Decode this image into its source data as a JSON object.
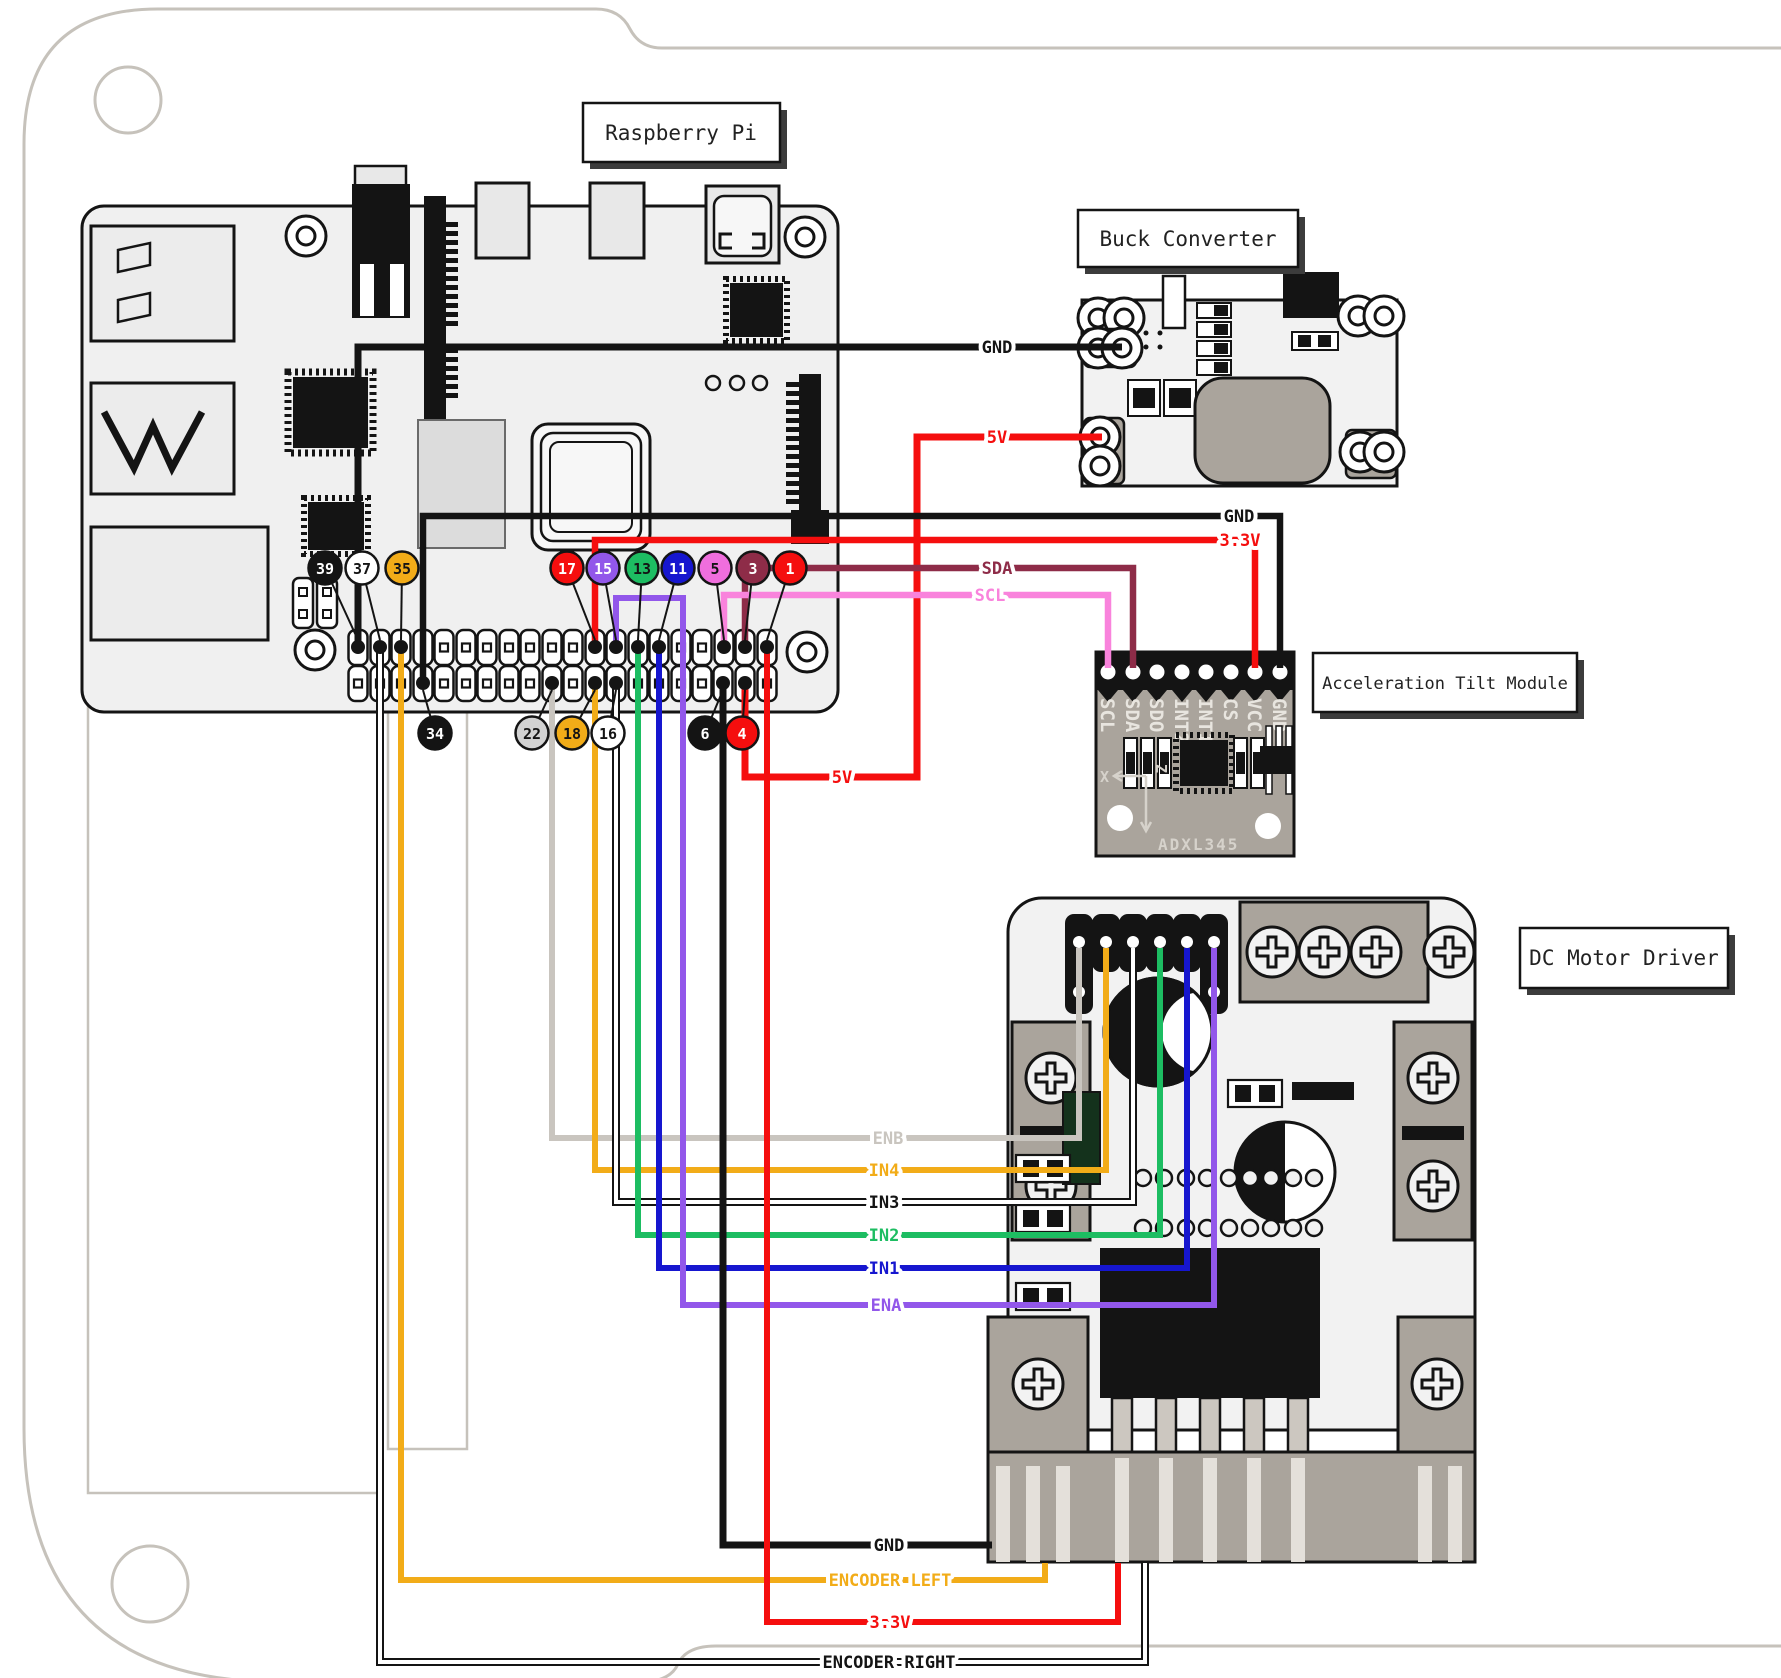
{
  "title_boxes": {
    "pi": "Raspberry Pi",
    "buck": "Buck Converter",
    "tilt": "Acceleration Tilt Module",
    "driver": "DC Motor Driver"
  },
  "pi_pins": {
    "p39": {
      "n": "39",
      "color": "#141414"
    },
    "p37": {
      "n": "37",
      "color": "#ffffff"
    },
    "p35": {
      "n": "35",
      "color": "#f2ac18"
    },
    "p17": {
      "n": "17",
      "color": "#f50e0e"
    },
    "p15": {
      "n": "15",
      "color": "#9257ea"
    },
    "p13": {
      "n": "13",
      "color": "#1dbd62"
    },
    "p11": {
      "n": "11",
      "color": "#1616cf"
    },
    "p5": {
      "n": "5",
      "color": "#f06edd"
    },
    "p3": {
      "n": "3",
      "color": "#8e2c48"
    },
    "p1": {
      "n": "1",
      "color": "#f50e0e"
    },
    "p34": {
      "n": "34",
      "color": "#141414"
    },
    "p22": {
      "n": "22",
      "color": "#d2d2d2"
    },
    "p18": {
      "n": "18",
      "color": "#f2ac18"
    },
    "p16": {
      "n": "16",
      "color": "#ffffff"
    },
    "p6": {
      "n": "6",
      "color": "#141414"
    },
    "p4": {
      "n": "4",
      "color": "#f50e0e"
    }
  },
  "wires": {
    "gnd_buck": {
      "label": "GND",
      "color": "#141414"
    },
    "v5": {
      "label": "5V",
      "color": "#f50e0e"
    },
    "gnd_tilt": {
      "label": "GND",
      "color": "#141414"
    },
    "v33_tilt": {
      "label": "3.3V",
      "color": "#f50e0e"
    },
    "sda": {
      "label": "SDA",
      "color": "#8e2c48"
    },
    "scl": {
      "label": "SCL",
      "color": "#f983dc"
    },
    "enb": {
      "label": "ENB",
      "color": "#c9c5bf"
    },
    "in4": {
      "label": "IN4",
      "color": "#f2ac18"
    },
    "in3": {
      "label": "IN3",
      "color": "#141414"
    },
    "in2": {
      "label": "IN2",
      "color": "#1dbd62"
    },
    "in1": {
      "label": "IN1",
      "color": "#1616cf"
    },
    "ena": {
      "label": "ENA",
      "color": "#9257ea"
    },
    "gnd_driver": {
      "label": "GND",
      "color": "#141414"
    },
    "enc_left": {
      "label": "ENCODER LEFT",
      "color": "#f2ac18"
    },
    "v33_driver": {
      "label": "3.3V",
      "color": "#f50e0e"
    },
    "enc_right": {
      "label": "ENCODER RIGHT",
      "color": "#141414"
    }
  },
  "tilt": {
    "pins": [
      "SCL",
      "SDA",
      "SDO",
      "INT2",
      "INT1",
      "CS",
      "VCC",
      "GND"
    ],
    "chip_label": "ADXL345",
    "axis_x": "X",
    "axis_z": "Z"
  }
}
